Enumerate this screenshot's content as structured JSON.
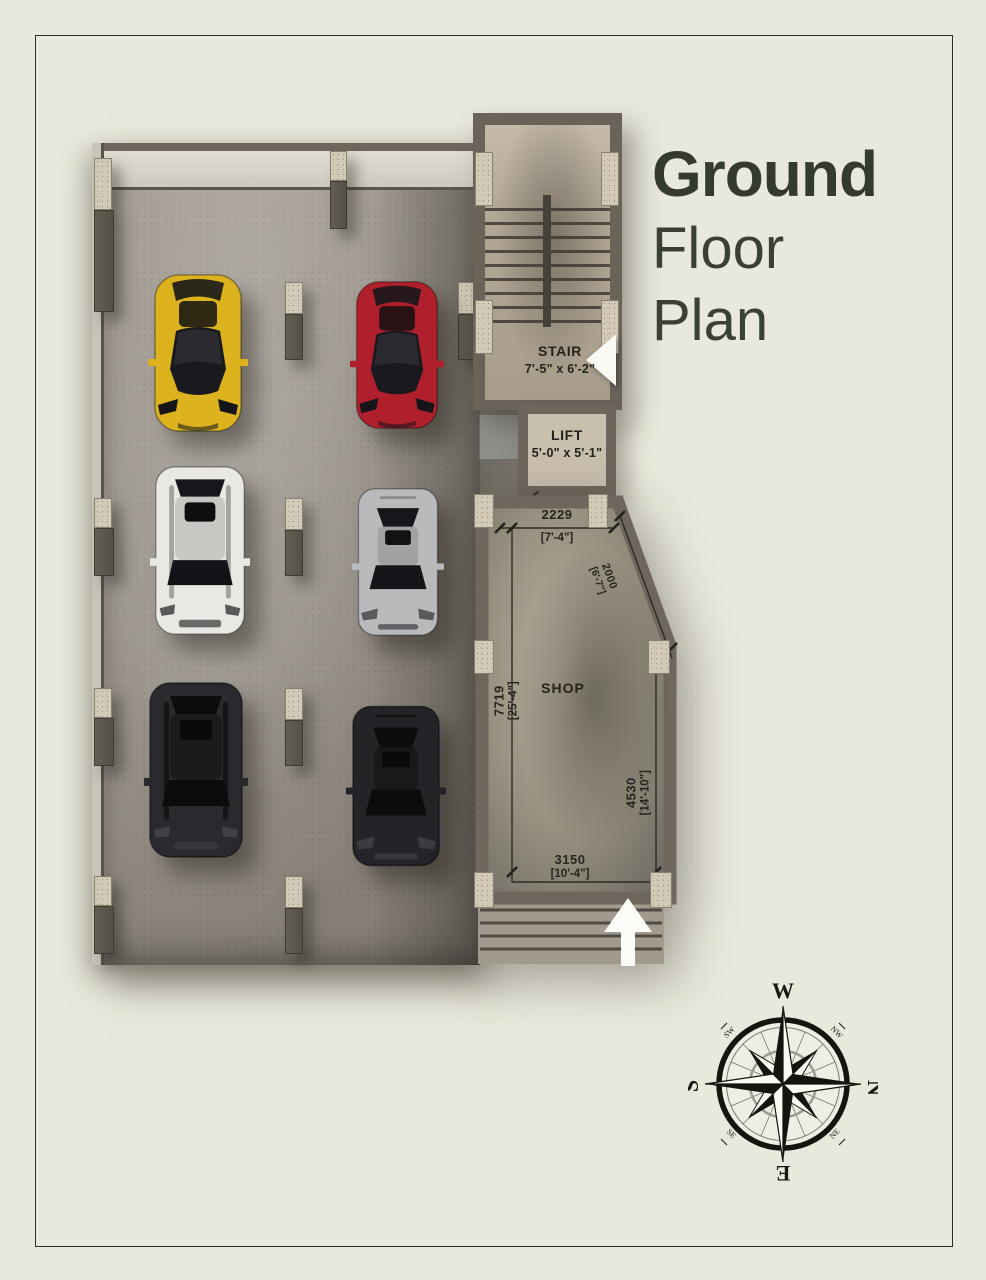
{
  "title": {
    "line1": "Ground",
    "line2": "Floor",
    "line3": "Plan"
  },
  "rooms": {
    "stair": {
      "label": "STAIR",
      "size": "7'-5\" x 6'-2\""
    },
    "lift": {
      "label": "LIFT",
      "size": "5'-0\" x 5'-1\""
    },
    "shop": {
      "label": "SHOP"
    }
  },
  "dims": {
    "top_mm": "2229",
    "top_ft": "[7'-4\"]",
    "diag_mm": "2000",
    "diag_ft": "[6'-7\"]",
    "left_mm": "7719",
    "left_ft": "[25'-4\"]",
    "right_mm": "4530",
    "right_ft": "[14'-10\"]",
    "bottom_mm": "3150",
    "bottom_ft": "[10'-4\"]"
  },
  "cars": [
    {
      "name": "yellow sports car",
      "color": "#dcb31e"
    },
    {
      "name": "red sports car",
      "color": "#b0202c"
    },
    {
      "name": "white suv",
      "color": "#e9e8e3"
    },
    {
      "name": "silver sedan",
      "color": "#b9babc"
    },
    {
      "name": "black suv",
      "color": "#2a2a2e"
    },
    {
      "name": "black sedan",
      "color": "#242428"
    }
  ],
  "compass": {
    "top": "W",
    "right": "N",
    "bottom": "E",
    "left": "S",
    "top_left": "SW",
    "top_right": "NW",
    "bottom_left": "SE",
    "bottom_right": "NE"
  }
}
